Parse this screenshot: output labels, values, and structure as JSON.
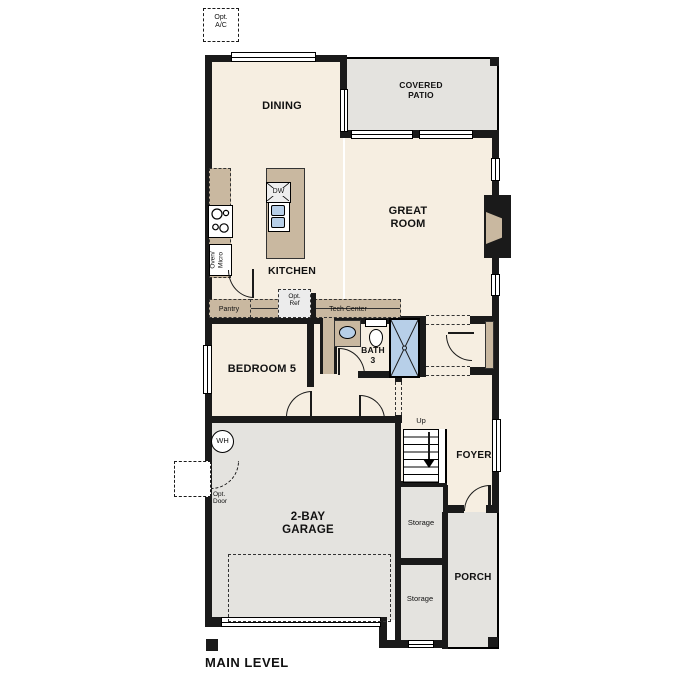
{
  "plan": {
    "level_label": "MAIN LEVEL",
    "rooms": {
      "dining": "DINING",
      "covered_patio": "COVERED\nPATIO",
      "great_room": "GREAT\nROOM",
      "kitchen": "KITCHEN",
      "bedroom_5": "BEDROOM 5",
      "bath_3": "BATH\n3",
      "foyer": "FOYER",
      "garage": "2-BAY\nGARAGE",
      "porch": "PORCH",
      "storage_upper": "Storage",
      "storage_lower": "Storage"
    },
    "features": {
      "opt_ac": "Opt.\nA/C",
      "pantry": "Pantry",
      "opt_ref": "Opt.\nRef",
      "tech_center": "Tech Center",
      "oven_micro": "Oven/\nMicro",
      "dishwasher": "DW",
      "water_heater": "WH",
      "opt_door": "Opt.\nDoor",
      "stairs_direction": "Up"
    },
    "colors": {
      "interior": "#f6eee1",
      "outdoor_gray": "#e4e3df",
      "counter_tan": "#c9b8a0",
      "fixture_blue": "#b7cfe8",
      "wall_black": "#1a1a1a"
    }
  }
}
